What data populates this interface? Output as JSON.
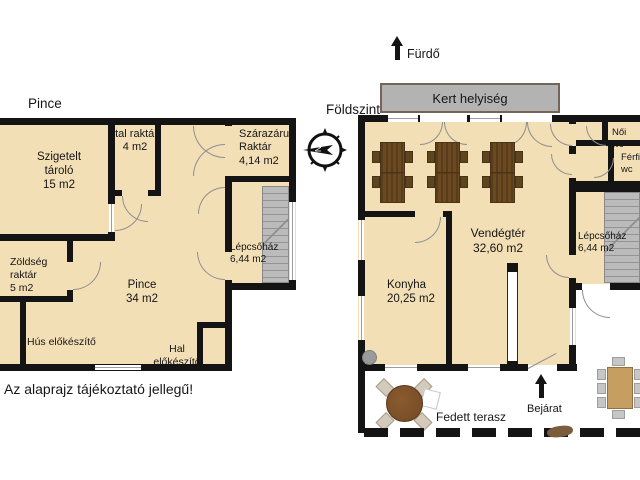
{
  "page": {
    "footer": "Az alaprajz tájékoztató jellegű!"
  },
  "colors": {
    "floor": "#F3DFB6",
    "wall": "#141414",
    "stairs": "#BBBBBB",
    "garden": "#B3B3B3",
    "table_dark": "#6B4A22",
    "table_light": "#C79E62",
    "terrace_table": "#7A4F28",
    "chair": "#C6C6C6"
  },
  "compass": {
    "north_label": "N"
  },
  "basement": {
    "title": "Pince",
    "rooms": {
      "szigetelt": {
        "name": "Szigetelt tároló",
        "area": "15 m2"
      },
      "ital": {
        "name": "Ital raktár",
        "area": "4 m2"
      },
      "szarazaru": {
        "name": "Szárazáru Raktár",
        "area": "4,14 m2"
      },
      "zoldseg": {
        "name": "Zöldség raktár",
        "area": "5 m2"
      },
      "pince": {
        "name": "Pince",
        "area": "34 m2"
      },
      "lepcsohaz": {
        "name": "Lépcsőház",
        "area": "6,44 m2"
      },
      "hus": {
        "name": "Hús előkészítő"
      },
      "hal": {
        "name": "Hal előkészítő"
      }
    }
  },
  "ground_floor": {
    "title": "Földszint",
    "direction_label": "Fürdő",
    "garden_room": "Kert helyiség",
    "rooms": {
      "vendegter": {
        "name": "Vendégtér",
        "area": "32,60 m2"
      },
      "konyha": {
        "name": "Konyha",
        "area": "20,25 m2"
      },
      "lepcsohaz": {
        "name": "Lépcsőház",
        "area": "6,44 m2"
      },
      "noi_wc": {
        "name": "Női wc"
      },
      "ferfi_wc": {
        "name": "Férfi wc"
      },
      "terasz": {
        "name": "Fedett terasz"
      },
      "bejarat": {
        "name": "Bejárat"
      }
    }
  }
}
